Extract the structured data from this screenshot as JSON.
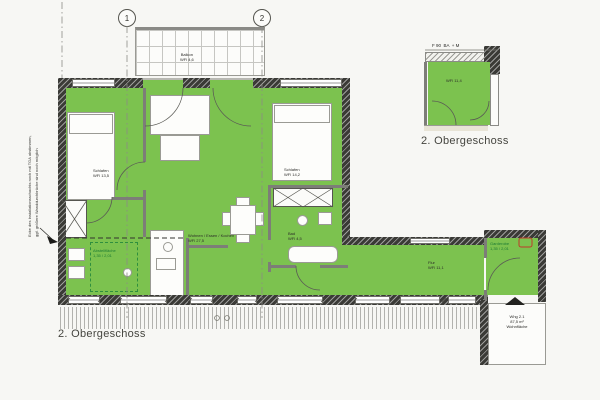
{
  "captions": {
    "main": "2. Obergeschoss",
    "inset": "2. Obergeschoss"
  },
  "grid": {
    "m1": "1",
    "m2": "2"
  },
  "balcony": {
    "name": "Balkon",
    "area": "WFl 4,6"
  },
  "rooms": {
    "bedroom_left": {
      "name": "Schlafen",
      "area": "WFl 13,5"
    },
    "living": {
      "name": "Wohnen / Essen / Kochen",
      "area": "WFl 27,5"
    },
    "bedroom_right": {
      "name": "Schlafen",
      "area": "WFl 14,2"
    },
    "bad": {
      "name": "Bad",
      "area": "WFl 4,5"
    },
    "flur": {
      "name": "Flur",
      "area": "WFl 11,1"
    },
    "inset_room": {
      "area": "WFl 11,4"
    }
  },
  "notes": {
    "shower_line1": "Abstellfläche",
    "shower_line2": "1,35 / 2,01",
    "entry_line1": "Garderobe",
    "entry_line2": "1,35 / 2,01"
  },
  "annotations": {
    "left_note_1": "Ecke des Installationsschachts noch mit TGA abstimmen,",
    "left_note_2": "ggf. größere Wanddurchbrüche sind noch möglich",
    "inset_header": "F 90  BA  + M",
    "stair_1": "Whg 2.1",
    "stair_2": "87,5 m²",
    "stair_3": "Wohnfläche"
  },
  "colors": {
    "room_green": "#7CC24F",
    "wall_dark": "#3A3A36",
    "accent_red": "#C0392B"
  }
}
